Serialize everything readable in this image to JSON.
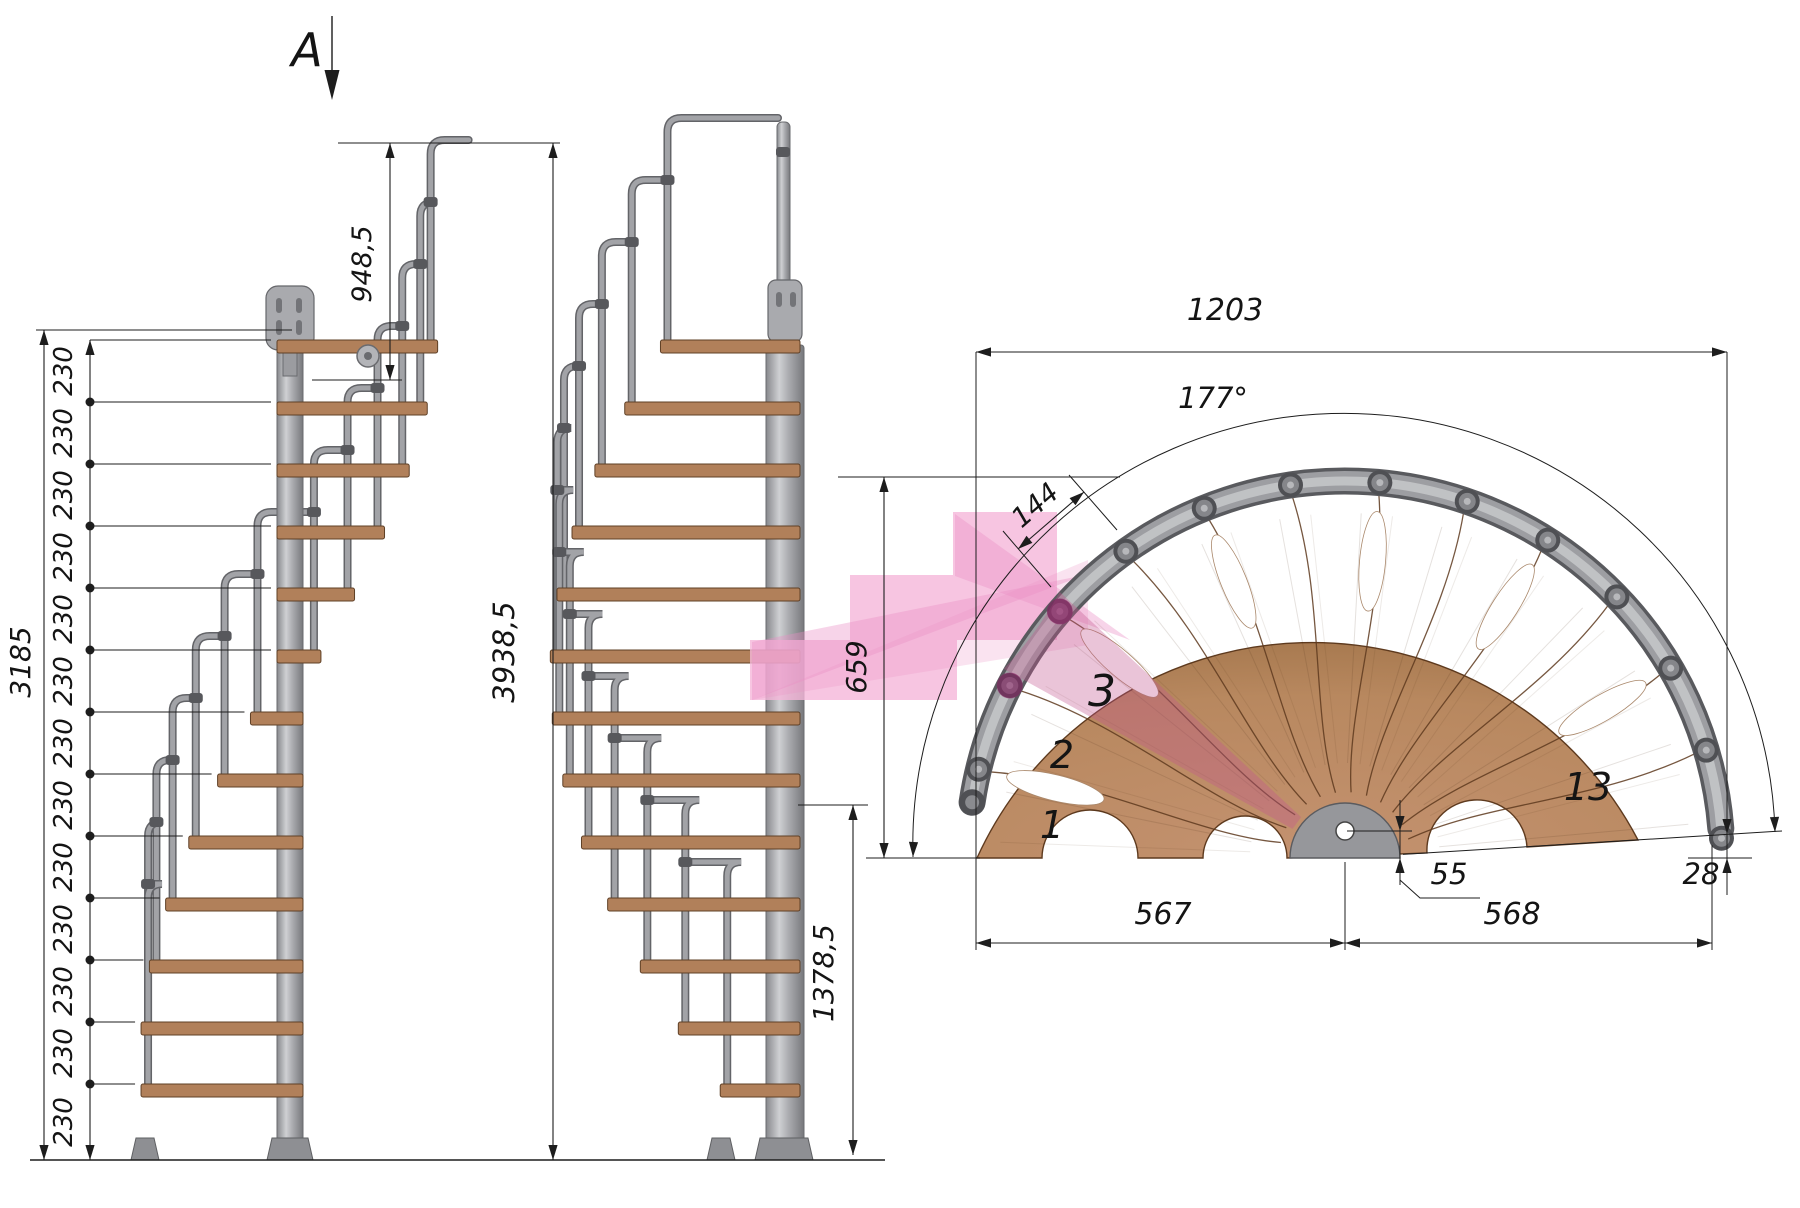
{
  "section_marker": "A",
  "side_view": {
    "stair_height": "3185",
    "riser_height": "230",
    "riser_count": 13,
    "handrail_height": "948,5",
    "total_rail_height": "3938,5",
    "module_height": "1378,5",
    "module_depth": "659"
  },
  "plan_view": {
    "overall_width": "1203",
    "rotation_angle": "177°",
    "step_outer_width": "144",
    "left_half": "567",
    "right_half": "568",
    "center_offset": "55",
    "end_offset": "28",
    "step_labels": {
      "first": "1",
      "second": "2",
      "third": "3",
      "last": "13"
    }
  },
  "colors": {
    "line": "#1d1d1d",
    "wood_plan": "#b98a62",
    "wood_plan_edge": "#5e3a1e",
    "tread_wood": "#b1805a",
    "tread_edge": "#5f4026",
    "metal": "#a2a3a7",
    "metal_light": "#c6c7ca",
    "metal_dark": "#636468",
    "rail_dark": "#595a5e",
    "highlight_pink": "#f5b6da",
    "highlight_beam": "#eb8fc4",
    "highlight_deep": "#c2568f"
  }
}
